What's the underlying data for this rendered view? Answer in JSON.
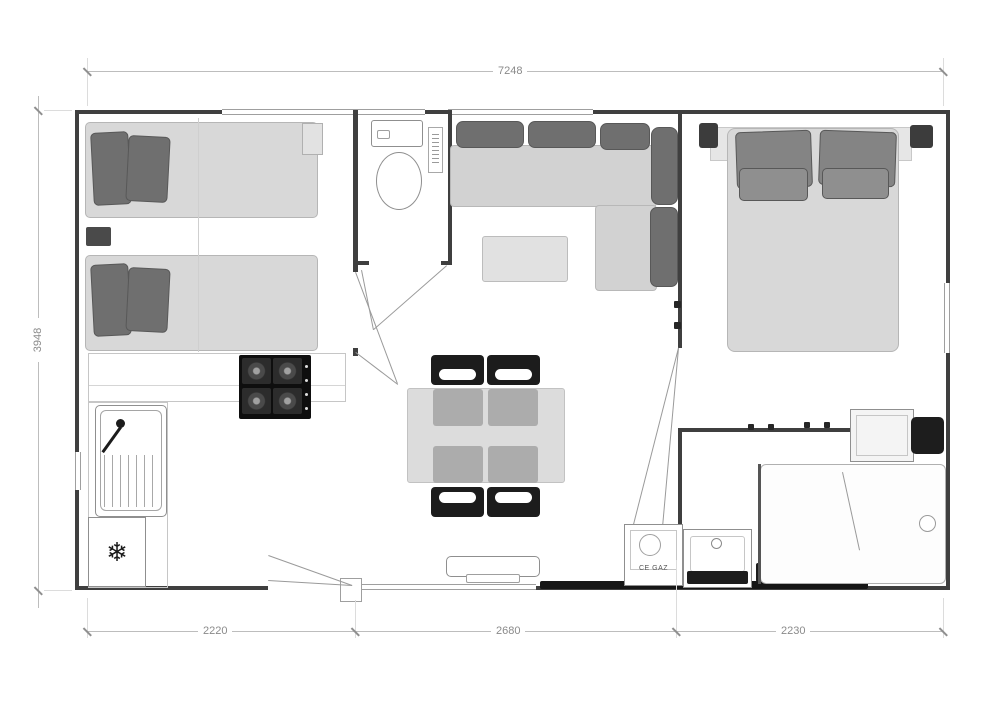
{
  "plan": {
    "title": "mobile-home floor plan",
    "dimensions": {
      "top_width": "7248",
      "left_height": "3948",
      "bottom_sections": [
        "2220",
        "2680",
        "2230"
      ]
    },
    "labels": {
      "gas_unit": "CE GAZ"
    },
    "icons": {
      "snowflake": "❄"
    },
    "colors": {
      "wall": "#3f3f3f",
      "furniture_light": "#d8d8d8",
      "cushion_dark": "#6f6f6f",
      "black_accent": "#1c1c1c",
      "dimension_line": "#bdbdbd",
      "dimension_text": "#8a8a8a",
      "background": "#ffffff"
    }
  }
}
